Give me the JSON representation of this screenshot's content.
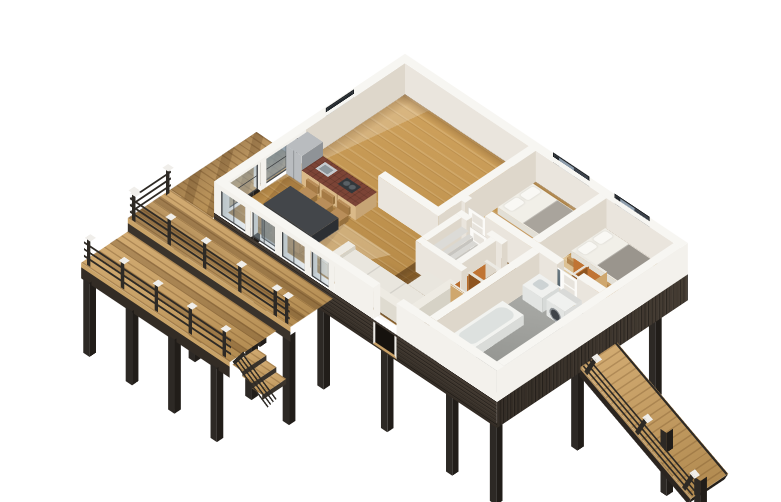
{
  "scene": {
    "kind": "isometric-3d-floor-plan-render",
    "background": "#ffffff"
  },
  "palette": {
    "wall_top": "#f7f6f2",
    "wall_exterior": "#f3f1ec",
    "wall_interior": "#eae5dd",
    "wall_interior_side": "#ded7cb",
    "floor_wood_light": "#cfa25d",
    "floor_wood": "#c0934f",
    "floor_wood_dark": "#aa7e3e",
    "deck_wood_light": "#d2ab72",
    "deck_wood": "#c7a066",
    "deck_wood_dark": "#b18a50",
    "gloss_hall_a": "rgba(86,50,12,0.55)",
    "gloss_hall_b": "rgba(56,30,6,0.5)",
    "gloss_hall_c": "rgba(110,65,18,0.42)",
    "gray_floor_a": "#acada9",
    "gray_floor_b": "#8b8d89",
    "siding_a": "#453c33",
    "siding_b": "#332c25",
    "post": "#2d2925",
    "post_side": "#211d19",
    "rail": "#2e2a25",
    "post_cap": "#f0eeea",
    "glass_a": "rgba(140,160,172,0.55)",
    "glass_b": "rgba(180,195,205,0.35)",
    "frame_dark": "#3e4144",
    "window_edge": "#1e2226",
    "window_dark": "#23282d",
    "window_glass": "#8d9cab",
    "window_sash": "#39404a",
    "counter_top": "#7c4436",
    "counter_base": "#dab988",
    "steel": "#b9bcbf",
    "steel_dark": "#8f9397",
    "sink": "#c6cbcf",
    "cooktop": "#33373b",
    "table": "#43464a",
    "table_side": "#33363a",
    "chair": "#b98e5a",
    "chair_side": "#a57a45",
    "sofa": "#e9e6de",
    "sofa_side": "#dcd8cd",
    "sofa_dark": "#d3cfc3",
    "bed_frame": "#c69c63",
    "bed_frame_side": "#b2854e",
    "linen": "#f1efe8",
    "linen_side": "#e2dfd6",
    "pillow": "#f9f8f4",
    "blanket_bed1": "#a9a49c",
    "blanket_bed2": "#9a958d",
    "wardrobe_orange": "#c07434",
    "wardrobe_orange_dark": "#8f5520",
    "wardrobe_base": "#8a5a2a",
    "wood_shelf": "#cfa76e",
    "fixture_white": "#f0f1ef",
    "fixture_side": "#e2e4e2",
    "tub_inner": "#dde1df",
    "stair_tread": "#d9d8d4",
    "stair_riser": "#c7c5c0",
    "mirror_a": "#7b8b94",
    "mirror_b": "#55646d",
    "door_white": "#fbfaf7",
    "door_panel": "#e7e3dc",
    "shadow_warm": "rgba(88,54,20,0.3)",
    "deck_band_shadow": "rgba(70,42,15,0.3)",
    "sun_patch": "rgba(255,250,233,0.45)"
  },
  "inventory": {
    "rooms": [
      "kitchen",
      "dining-area",
      "living-room",
      "hallway",
      "bedroom-1",
      "bedroom-2",
      "bathroom",
      "stair-closet"
    ],
    "furniture": [
      "refrigerator",
      "kitchen-counter",
      "kitchen-sink",
      "cooktop",
      "dining-table",
      "dining-chairs",
      "sectional-sofa",
      "bed-1",
      "bed-2",
      "bathtub",
      "washing-machine",
      "vanity",
      "mirror",
      "wardrobe-1",
      "wardrobe-2",
      "staircase",
      "interior-doors"
    ],
    "exterior": [
      "deck-west",
      "deck-south-upper",
      "deck-lower",
      "deck-railings",
      "deck-steps",
      "entry-ramp",
      "ramp-railing",
      "stilt-posts",
      "dark-wood-siding",
      "entry-notch",
      "sliding-glass-doors",
      "window-bedroom-1",
      "window-bedroom-2",
      "window-kitchen"
    ]
  }
}
